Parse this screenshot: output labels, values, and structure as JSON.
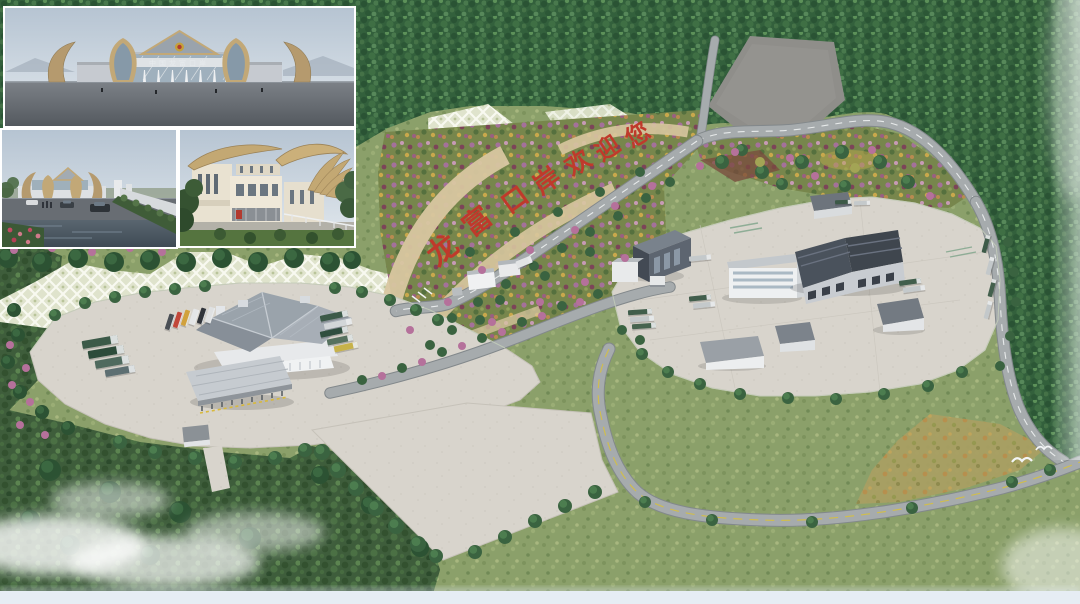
{
  "scene": {
    "title": "Longfu Port aerial rendering",
    "hillside": {
      "slogan": "龙富口岸欢迎您",
      "slogan_chars": [
        "龙",
        "富",
        "口",
        "岸",
        "欢",
        "迎",
        "您"
      ],
      "slogan_color": "#bf3a2b"
    },
    "insets": {
      "front_sign_text": "中国龙富口岸"
    },
    "palette": {
      "forest": "#33603c",
      "meadow": "#8ba06a",
      "dry_meadow": "#a89f63",
      "paving": "#d8d4cc",
      "road": "#a6abad",
      "roof_dark": "#49515b",
      "building_white": "#eef0f1",
      "slope_grid": "#e3e7d2",
      "terrace_beige": "#d8c6a0",
      "flower_pink": "#b5719b",
      "gravel_plot": "#8f8e8a",
      "inset_sky": "#b6c4d2",
      "mist": "#ffffff"
    }
  }
}
